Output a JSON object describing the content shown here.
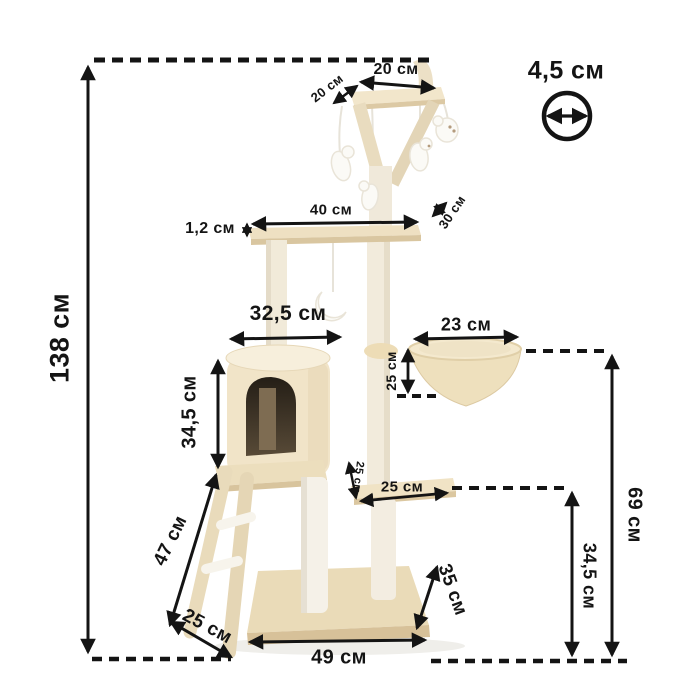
{
  "diagram": {
    "subject": "Cat tree scratching post dimension diagram",
    "unit": "см",
    "line_color": "#141414",
    "plush_color": "#efe2c6",
    "pole_color": "#f2ebdc",
    "toy_color": "#fbfaf6",
    "opening_dark_color": "#2a241b",
    "icons": {
      "diameter": "circle-diameter-icon"
    }
  },
  "dimensions": {
    "total_height": "138 см",
    "top_platform_width": "20 см",
    "top_platform_depth": "20 см",
    "post_diameter": "4,5 см",
    "upper_platform_width": "40 см",
    "board_thickness": "1,2 см",
    "upper_platform_depth": "30 см",
    "house_width": "32,5 см",
    "house_height": "34,5 см",
    "basket_width": "23 см",
    "basket_depth": "25 см",
    "lower_platform_offset": "25 см",
    "lower_platform_width": "25 см",
    "ladder_length": "47 см",
    "ladder_width": "25 см",
    "base_width": "49 см",
    "base_depth": "35 см",
    "lower_platform_height": "34,5 см",
    "basket_height": "69 см"
  }
}
